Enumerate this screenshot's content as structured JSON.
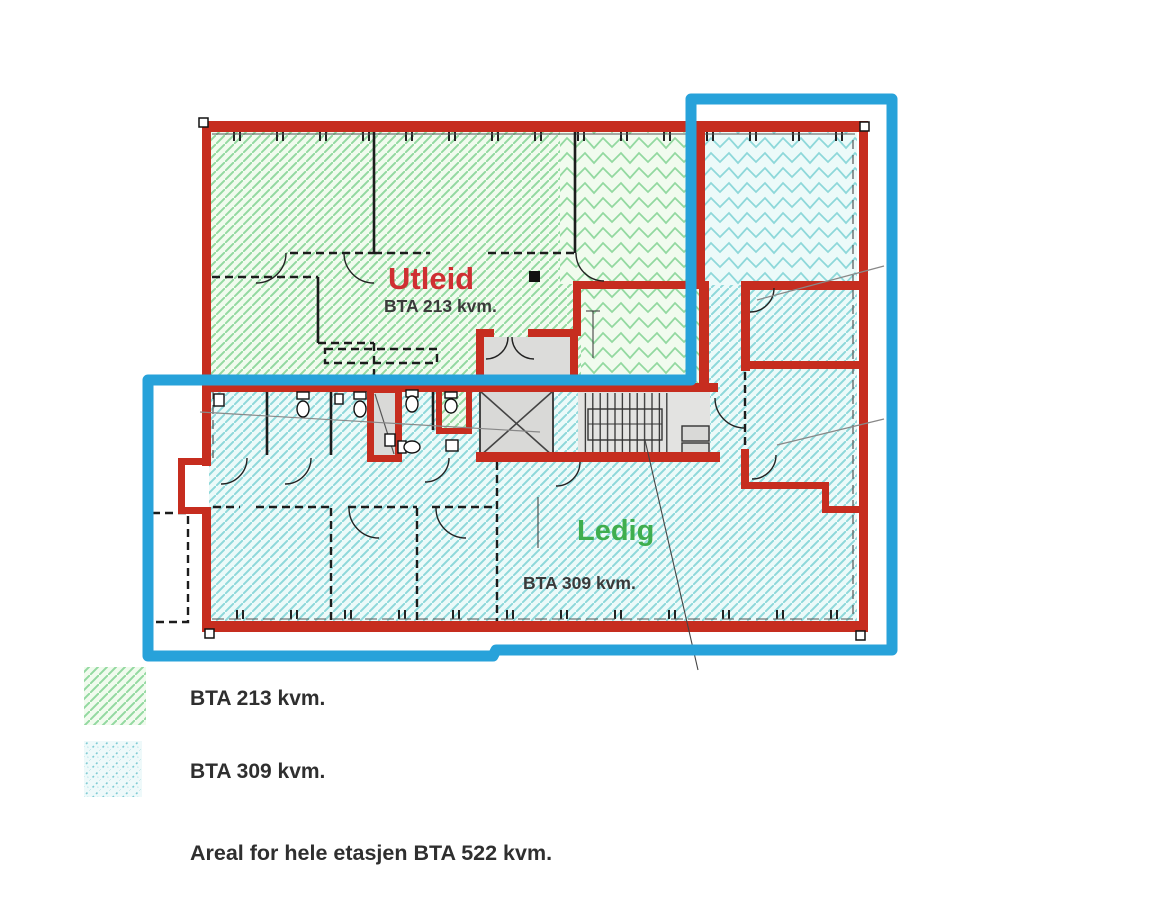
{
  "plan": {
    "utleid": {
      "title": "Utleid",
      "area": "BTA 213 kvm."
    },
    "ledig": {
      "title": "Ledig",
      "area": "BTA 309 kvm."
    }
  },
  "legend": {
    "rented_label": "BTA 213 kvm.",
    "vacant_label": "BTA 309 kvm.",
    "total_label": "Areal for hele etasjen BTA 522 kvm."
  },
  "colors": {
    "outline_blue": "#27a2da",
    "wall_red": "#c62d1f",
    "utleid_text": "#cf2f32",
    "ledig_text": "#3fae4e",
    "label_text": "#3a3a3a",
    "legend_text": "#2f2f2f",
    "hatch_green": "#93d9a0",
    "hatch_cyan": "#8ed8da"
  }
}
